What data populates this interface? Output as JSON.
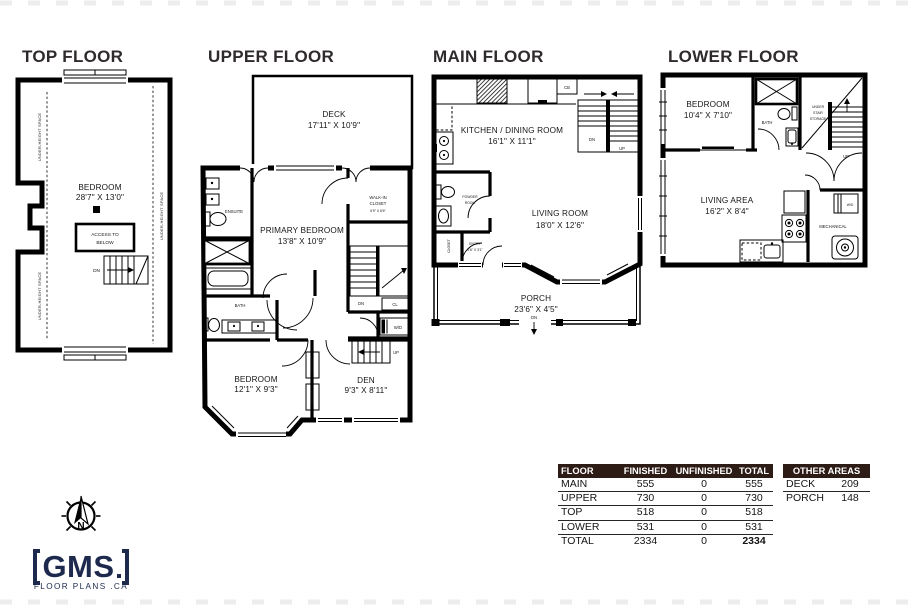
{
  "titles": {
    "top": "TOP FLOOR",
    "upper": "UPPER FLOOR",
    "main": "MAIN FLOOR",
    "lower": "LOWER FLOOR"
  },
  "top": {
    "bedroom": "BEDROOM",
    "bedroom_dim": "28'7\" X 13'0\"",
    "access1": "ACCESS TO",
    "access2": "BELOW",
    "dn": "DN",
    "under_height": "UNDER-HEIGHT SPACE"
  },
  "upper": {
    "deck": "DECK",
    "deck_dim": "17'11\" X 10'9\"",
    "ensuite": "ENSUITE",
    "primary": "PRIMARY BEDROOM",
    "primary_dim": "13'8\" X 10'9\"",
    "walkin1": "WALK-IN",
    "walkin2": "CLOSET",
    "walkin_dim": "6'9\" X 6'6\"",
    "bath": "BATH",
    "dn": "DN",
    "cl": "CL",
    "wd": "W/D",
    "up": "UP",
    "bedroom": "BEDROOM",
    "bedroom_dim": "12'1\" X 9'3\"",
    "den": "DEN",
    "den_dim": "9'3\" X 8'11\"",
    "closet": "CLOSET"
  },
  "main": {
    "kitchen": "KITCHEN / DINING ROOM",
    "kitchen_dim": "16'1\" X 11'1\"",
    "cb": "CB",
    "dn": "DN",
    "up": "UP",
    "powder1": "POWDER",
    "powder2": "ROOM",
    "closet": "CLOSET",
    "entry": "ENTRY",
    "entry_dim": "4'6\" X 3'1\"",
    "living": "LIVING ROOM",
    "living_dim": "18'0\" X 12'6\"",
    "porch": "PORCH",
    "porch_dim": "23'6\" X 4'5\"",
    "porch_dn": "DN"
  },
  "lower": {
    "bedroom": "BEDROOM",
    "bedroom_dim": "10'4\" X 7'10\"",
    "bath": "BATH",
    "storage1": "UNDER",
    "storage2": "STAIR",
    "storage3": "STORAGE",
    "up": "UP",
    "living": "LIVING AREA",
    "living_dim": "16'2\" X 8'4\"",
    "wd": "W/D",
    "mechanical": "MECHANICAL"
  },
  "table": {
    "headers": [
      "FLOOR",
      "FINISHED",
      "UNFINISHED",
      "TOTAL"
    ],
    "rows": [
      [
        "MAIN",
        "555",
        "0",
        "555"
      ],
      [
        "UPPER",
        "730",
        "0",
        "730"
      ],
      [
        "TOP",
        "518",
        "0",
        "518"
      ],
      [
        "LOWER",
        "531",
        "0",
        "531"
      ]
    ],
    "total": [
      "TOTAL",
      "2334",
      "0",
      "2334"
    ]
  },
  "other": {
    "header": "OTHER AREAS",
    "rows": [
      [
        "DECK",
        "209"
      ],
      [
        "PORCH",
        "148"
      ]
    ]
  },
  "logo": {
    "brand": "GMS",
    "tagline": "FLOOR PLANS .CA",
    "north": "N"
  },
  "colors": {
    "wall": "#000000",
    "title": "#2f2b2c",
    "table_header_bg": "#2d1b16",
    "logo_navy": "#1e2a4d"
  }
}
